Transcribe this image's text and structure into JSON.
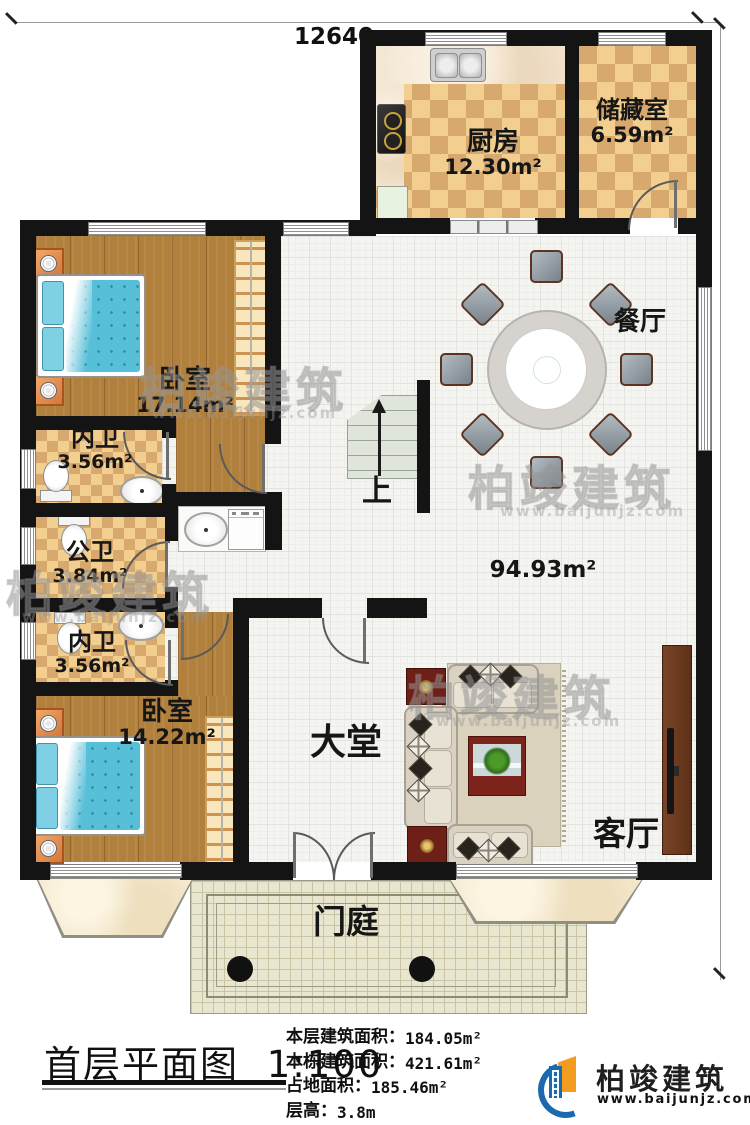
{
  "dimensions": {
    "top": "12640",
    "right": "17640"
  },
  "rooms": {
    "kitchen": {
      "label": "厨房",
      "area": "12.30m²"
    },
    "storage": {
      "label": "储藏室",
      "area": "6.59m²"
    },
    "dining": {
      "label": "餐厅",
      "area": ""
    },
    "bedroom1": {
      "label": "卧室",
      "area": "17.14m²"
    },
    "bath_inner1": {
      "label": "内卫",
      "area": "3.56m²"
    },
    "bath_public": {
      "label": "公卫",
      "area": "3.84m²"
    },
    "bath_inner2": {
      "label": "内卫",
      "area": "3.56m²"
    },
    "bedroom2": {
      "label": "卧室",
      "area": "14.22m²"
    },
    "hall": {
      "label": "大堂",
      "area": "94.93m²"
    },
    "living": {
      "label": "客厅",
      "area": ""
    },
    "porch": {
      "label": "门庭",
      "area": ""
    }
  },
  "stairs": {
    "label": "上"
  },
  "title": {
    "text": "首层平面图",
    "scale": "1:100"
  },
  "info": [
    {
      "label": "本层建筑面积：",
      "value": "184.05m²"
    },
    {
      "label": "本栋建筑面积：",
      "value": "421.61m²"
    },
    {
      "label": "占地面积：",
      "value": "185.46m²"
    },
    {
      "label": "层高：",
      "value": "3.8m"
    }
  ],
  "logo": {
    "name": "柏竣建筑",
    "url": "www.baijunjz.com"
  },
  "watermark": {
    "text": "柏竣建筑",
    "url": "www.baijunjz.com"
  },
  "colors": {
    "wall": "#141414",
    "checker_light": "#f2cf8f",
    "checker_dark": "#d7a96f",
    "wood": "#b1803c",
    "bed_blue": "#57bfd8",
    "logo_blue": "#1a6aad",
    "logo_orange": "#f39c1f"
  }
}
